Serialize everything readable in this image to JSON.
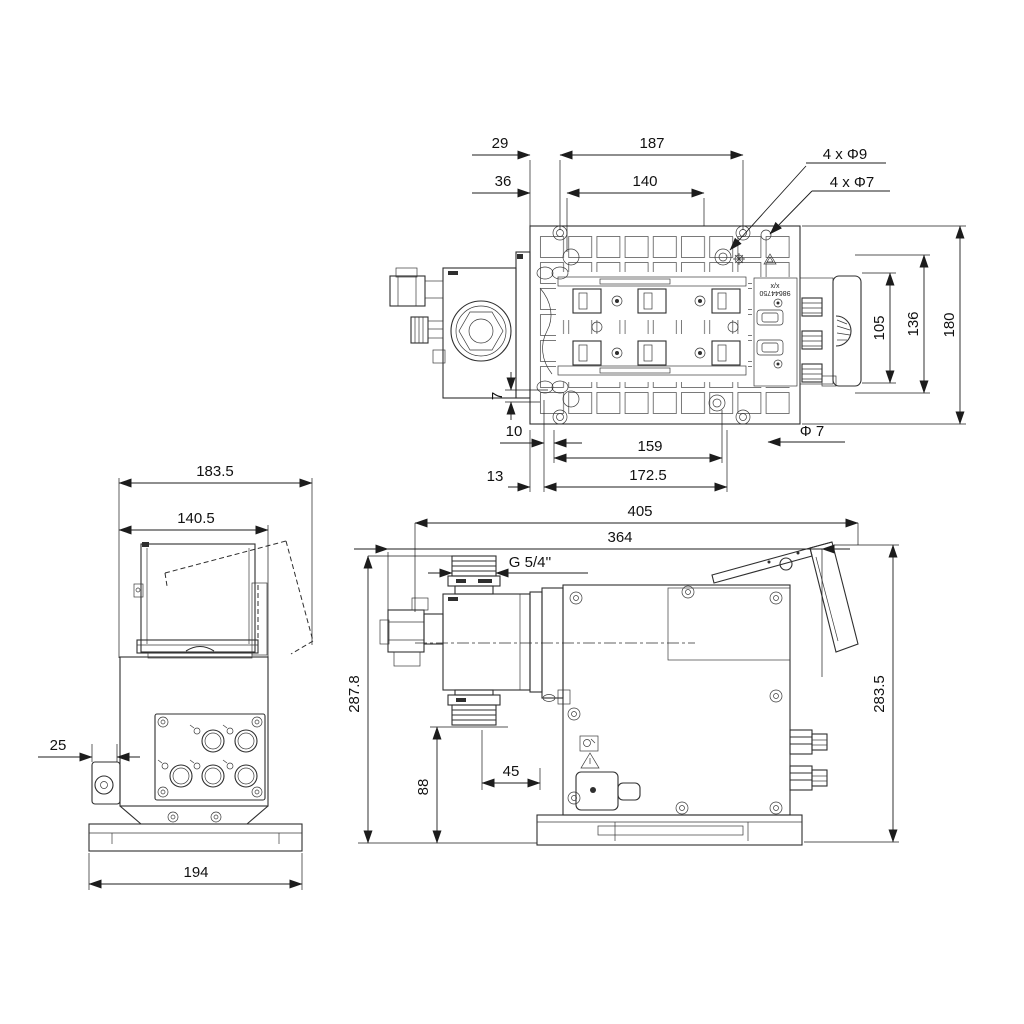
{
  "drawing": {
    "kind": "dosing-pump dimensional drawing",
    "colors": {
      "background": "#ffffff",
      "line": "#2f2f2f",
      "dimension": "#1c1c1c"
    }
  },
  "top_view": {
    "d29": "29",
    "d187": "187",
    "d36": "36",
    "d140": "140",
    "leader_phi9": "4 x Φ9",
    "leader_phi7": "4 x Φ7",
    "d105": "105",
    "d136": "136",
    "d180": "180",
    "d7": "7",
    "d10": "10",
    "d159": "159",
    "phi7": "Φ 7",
    "d13": "13",
    "d172_5": "172.5",
    "label_xx": "x/x",
    "label_part": "98644750"
  },
  "front_view": {
    "d183_5": "183.5",
    "d140_5": "140.5",
    "d25": "25",
    "d194": "194"
  },
  "side_view": {
    "d405": "405",
    "d364": "364",
    "thread": "G 5/4''",
    "d287_8": "287.8",
    "d88": "88",
    "d45": "45",
    "d283_5": "283.5"
  }
}
